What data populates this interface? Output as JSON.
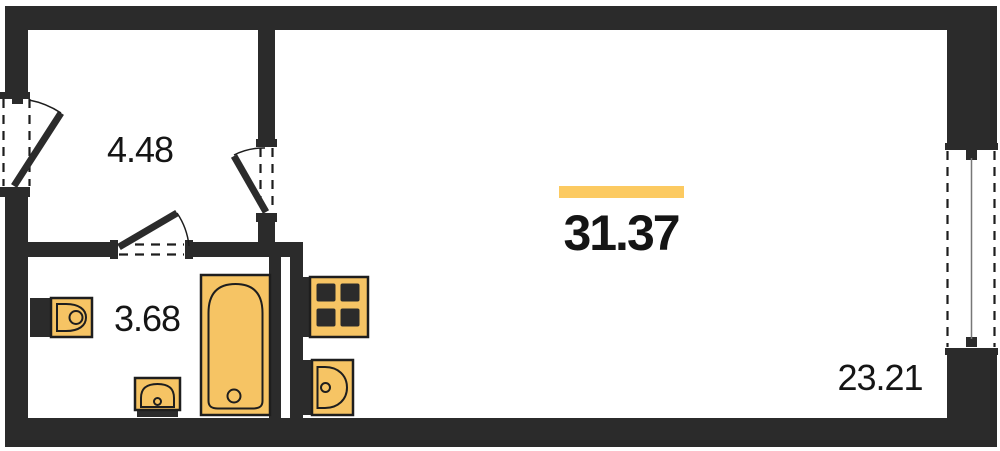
{
  "plan_title": "studio-apartment-floor-plan",
  "colors": {
    "wall": "#2b2b2b",
    "fixture": "#f6c464",
    "fixture_outline": "#1e1e1e",
    "accent_bar": "#fcca61",
    "text": "#151515",
    "bg": "#ffffff",
    "window_line": "#777777"
  },
  "rooms": {
    "hallway": {
      "area": "4.48"
    },
    "bathroom": {
      "area": "3.68"
    },
    "total": {
      "area": "31.37"
    },
    "living": {
      "area": "23.21"
    }
  },
  "fixtures": [
    "toilet",
    "sink-small",
    "bathtub",
    "stove-4-burner",
    "kitchen-sink"
  ],
  "openings": [
    "entrance-door-left-wall",
    "door-hallway-to-room",
    "door-hallway-to-bathroom",
    "window-right-wall"
  ]
}
